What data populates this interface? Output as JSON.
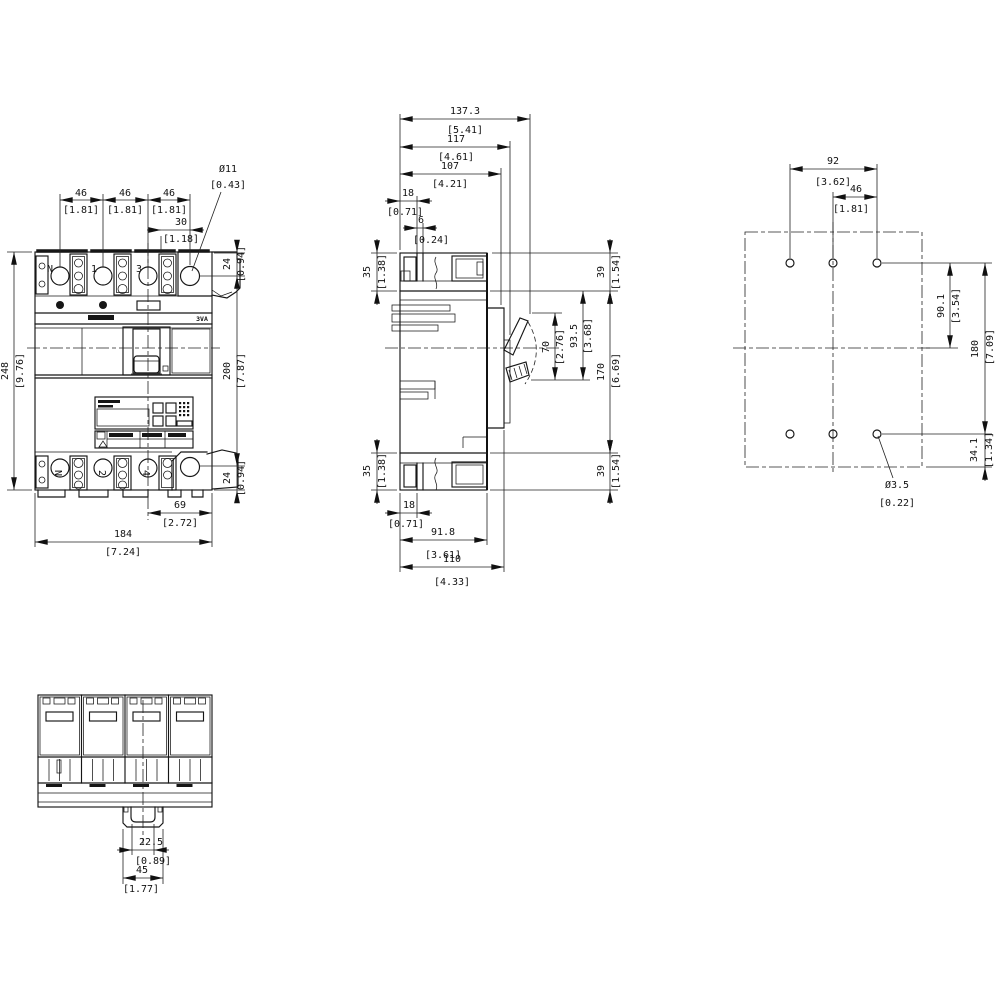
{
  "drawing": {
    "type": "circuit-breaker dimension drawing",
    "units": "mm [inch]"
  },
  "front": {
    "poles_top": [
      "N",
      "1",
      "3"
    ],
    "poles_bottom": [
      "N",
      "2",
      "4"
    ],
    "brand": "3VA",
    "pitch": [
      {
        "mm": "46",
        "in": "[1.81]"
      },
      {
        "mm": "46",
        "in": "[1.81]"
      },
      {
        "mm": "46",
        "in": "[1.81]"
      }
    ],
    "hole_offset": {
      "mm": "30",
      "in": "[1.18]"
    },
    "hole_dia": {
      "mm": "Ø11",
      "in": "[0.43]"
    },
    "hole_top": {
      "mm": "24",
      "in": "[0.94]"
    },
    "hole_span": {
      "mm": "200",
      "in": "[7.87]"
    },
    "hole_bottom": {
      "mm": "24",
      "in": "[0.94]"
    },
    "height": {
      "mm": "248",
      "in": "[9.76]"
    },
    "center_to_edge": {
      "mm": "69",
      "in": "[2.72]"
    },
    "width": {
      "mm": "184",
      "in": "[7.24]"
    }
  },
  "side": {
    "depth_total": {
      "mm": "137.3",
      "in": "[5.41]"
    },
    "depth_handle_pad": {
      "mm": "117",
      "in": "[4.61]"
    },
    "depth_cover": {
      "mm": "107",
      "in": "[4.21]"
    },
    "term_18_top": {
      "mm": "18",
      "in": "[0.71]"
    },
    "term_6": {
      "mm": "6",
      "in": "[0.24]"
    },
    "term_35_top": {
      "mm": "35",
      "in": "[1.38]"
    },
    "edge_39_top": {
      "mm": "39",
      "in": "[1.54]"
    },
    "handle_70": {
      "mm": "70",
      "in": "[2.76]"
    },
    "handle_93_5": {
      "mm": "93.5",
      "in": "[3.68]"
    },
    "body_170": {
      "mm": "170",
      "in": "[6.69]"
    },
    "edge_39_bottom": {
      "mm": "39",
      "in": "[1.54]"
    },
    "term_35_bottom": {
      "mm": "35",
      "in": "[1.38]"
    },
    "term_18_bottom": {
      "mm": "18",
      "in": "[0.71]"
    },
    "depth_body": {
      "mm": "91.8",
      "in": "[3.61]"
    },
    "depth_base": {
      "mm": "110",
      "in": "[4.33]"
    }
  },
  "drill": {
    "pitch_92": {
      "mm": "92",
      "in": "[3.62]"
    },
    "pitch_46": {
      "mm": "46",
      "in": "[1.81]"
    },
    "to_center_90_1": {
      "mm": "90.1",
      "in": "[3.54]"
    },
    "span_180": {
      "mm": "180",
      "in": "[7.09]"
    },
    "to_edge_34_1": {
      "mm": "34.1",
      "in": "[1.34]"
    },
    "hole_dia": {
      "mm": "Ø3.5",
      "in": "[0.22]"
    }
  },
  "bottom": {
    "din_22_5": {
      "mm": "22.5",
      "in": "[0.89]"
    },
    "din_45": {
      "mm": "45",
      "in": "[1.77]"
    }
  }
}
